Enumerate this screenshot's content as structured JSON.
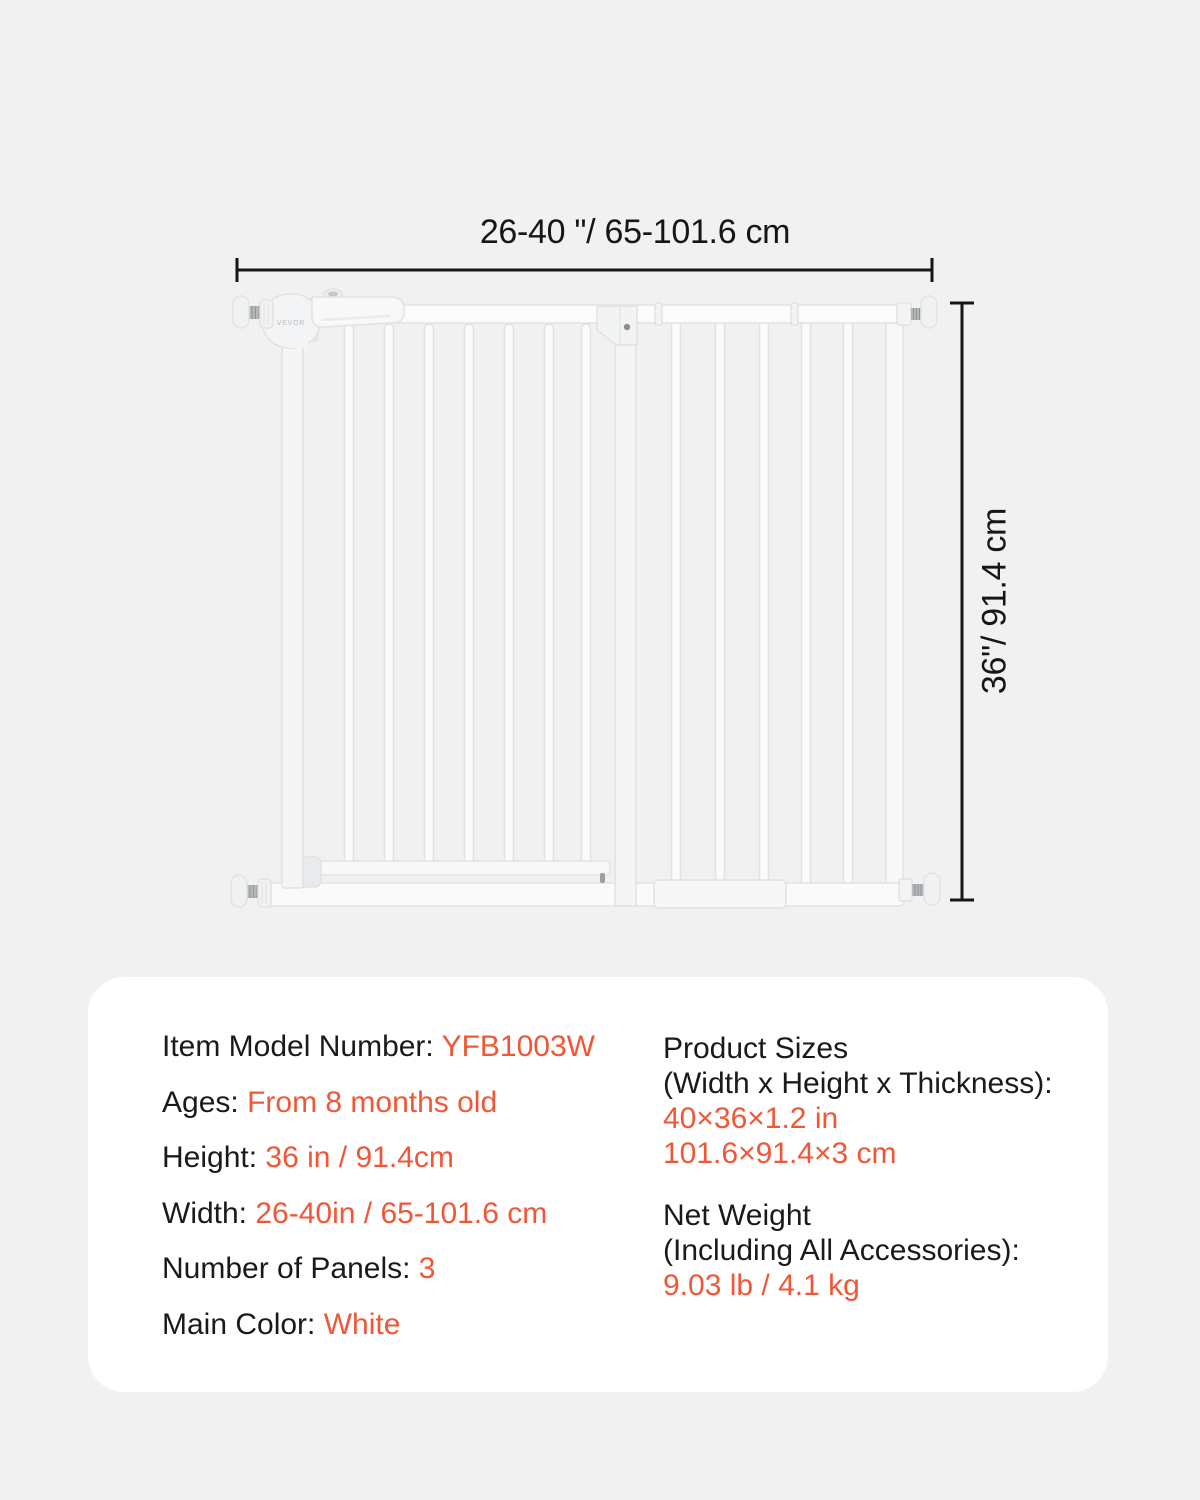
{
  "colors": {
    "background": "#f1f1f1",
    "card": "#ffffff",
    "accent": "#f15736",
    "text": "#1a1a1a",
    "dimension_line": "#161616",
    "gate_white": "#fbfbfb",
    "gate_outline": "#e2e2e2"
  },
  "diagram": {
    "width_label": "26-40 \"/ 65-101.6 cm",
    "height_label": "36\"/ 91.4 cm",
    "brand": "VEVOR"
  },
  "spec_card": {
    "left_rows": [
      {
        "label": "Item Model Number: ",
        "value": "YFB1003W"
      },
      {
        "label": "Ages: ",
        "value": "From 8 months old"
      },
      {
        "label": "Height: ",
        "value": "36 in / 91.4cm"
      },
      {
        "label": "Width: ",
        "value": "26-40in / 65-101.6 cm"
      },
      {
        "label": "Number of Panels: ",
        "value": "3"
      },
      {
        "label": "Main Color: ",
        "value": "White"
      }
    ],
    "right_blocks": [
      {
        "title_line1": "Product Sizes",
        "title_line2": "(Width x Height x Thickness):",
        "value_line1": "40×36×1.2 in",
        "value_line2": "101.6×91.4×3 cm"
      },
      {
        "title_line1": "Net Weight",
        "title_line2": "(Including All Accessories):",
        "value_line1": "9.03 lb / 4.1 kg"
      }
    ]
  }
}
